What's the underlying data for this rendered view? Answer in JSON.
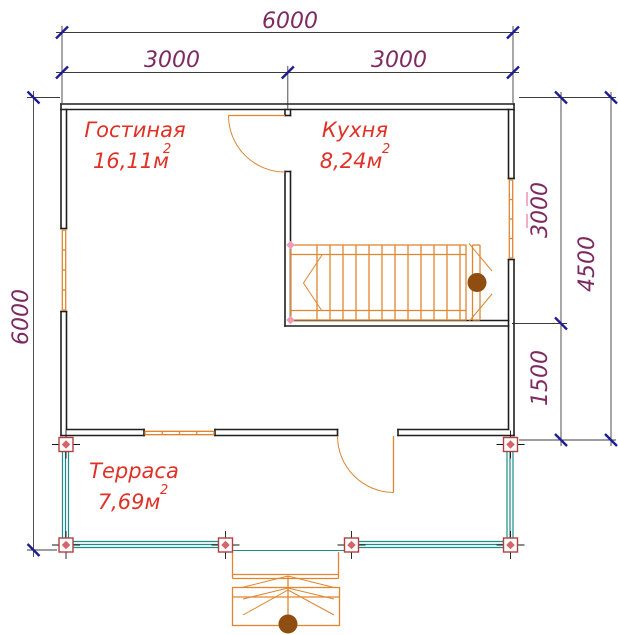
{
  "drawing": {
    "type": "floor-plan",
    "dimensions": {
      "top_total": "6000",
      "top_left": "3000",
      "top_right": "3000",
      "left_total": "6000",
      "right_upper": "3000",
      "right_lower": "1500",
      "right_total": "4500"
    },
    "rooms": {
      "living": {
        "name": "Гостиная",
        "area": "16,11м",
        "exp": "2"
      },
      "kitchen": {
        "name": "Кухня",
        "area": "8,24м",
        "exp": "2"
      },
      "terrace": {
        "name": "Терраса",
        "area": "7,69м",
        "exp": "2"
      }
    },
    "colors": {
      "wall": "#1f1f1f",
      "dim_line": "#3c3c3c",
      "dim_tick": "#1c1c96",
      "dim_text": "#7d2a60",
      "room_text": "#e03126",
      "joinery": "#e0862f",
      "railing": "#1d8c86",
      "post_stroke": "#b04040",
      "post_dot": "#d8626a",
      "newel": "#8f4d12",
      "marker_pink": "#ef9bb5"
    }
  }
}
